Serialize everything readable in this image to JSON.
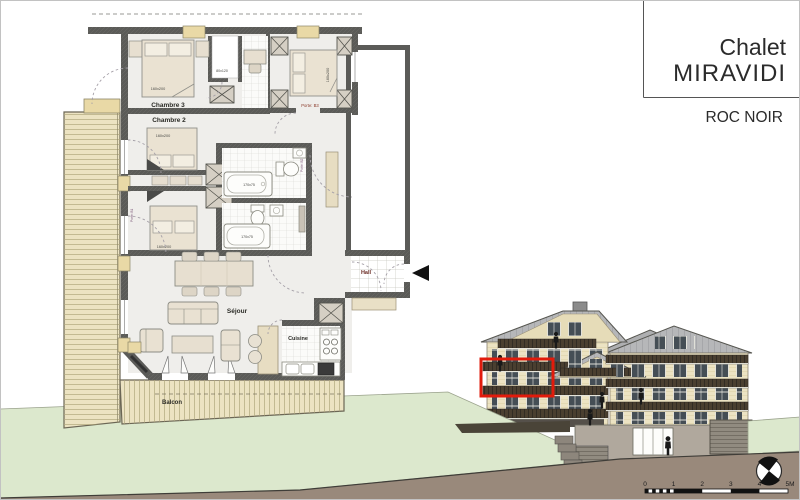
{
  "title_block": {
    "project": "Chalet",
    "name": "MIRAVIDI",
    "program": "ROC NOIR"
  },
  "floor_plan": {
    "rooms": {
      "chambre3": "Chambre 3",
      "chambre2": "Chambre 2",
      "chambre1": "Chambre 1",
      "sejour": "Séjour",
      "cuisine": "Cuisine",
      "hall": "Hall",
      "balcon": "Balcon"
    },
    "dims": {
      "bed3": "160x200",
      "bed2": "160x200",
      "bed1": "160x200",
      "bed4": "160x200",
      "shower": "80x120",
      "tub1": "170x75",
      "tub2": "170x75"
    },
    "doors": {
      "b1": "Porte: B1",
      "b2": "Porte: B2",
      "b3": "Porte: B3"
    }
  },
  "elevation": {
    "scale_ticks": [
      "0",
      "1",
      "2",
      "3",
      "4",
      "5M"
    ],
    "highlight_color": "#e11b0b"
  },
  "colors": {
    "wall": "#5b5b58",
    "wood_deck": "#ece3c2",
    "facade": "#ece3c3",
    "roof": "#b6b7b9",
    "balcony_rail": "#4a3f30",
    "grass": "#dce8cd",
    "terrain": "#99897b",
    "highlight": "#e11b0b"
  }
}
